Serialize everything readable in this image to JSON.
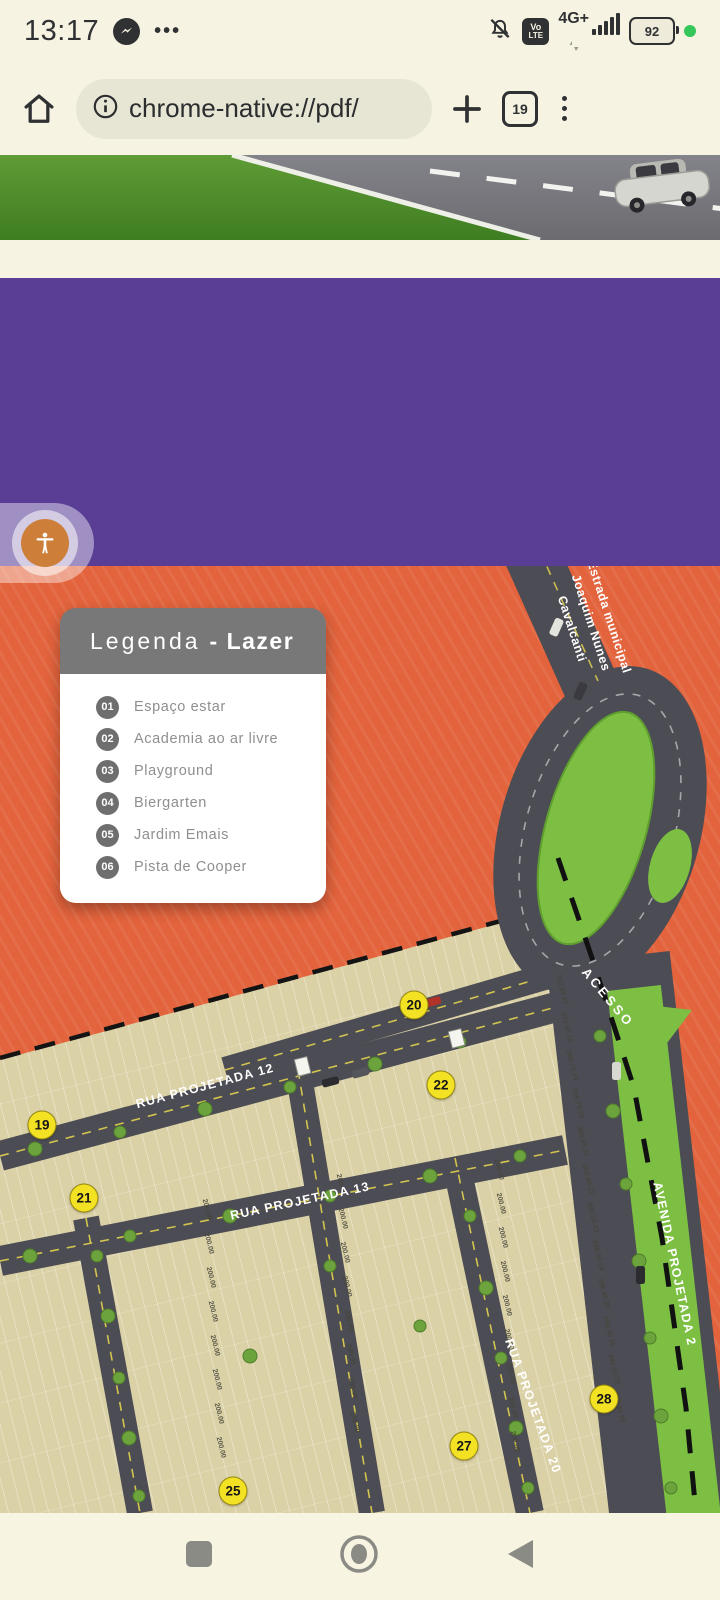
{
  "status_bar": {
    "time": "13:17",
    "more_icon": "•••",
    "carrier_badge_top": "Vo",
    "carrier_badge_bottom": "LTE",
    "network": "4G+",
    "battery": "92"
  },
  "toolbar": {
    "url": "chrome-native://pdf/",
    "tab_count": "19"
  },
  "pdf_banner": {
    "headline": "ESCOLHA AQUI"
  },
  "legend": {
    "title_light": "Legenda",
    "title_bold": "- Lazer",
    "items": [
      {
        "num": "01",
        "label": "Espaço estar"
      },
      {
        "num": "02",
        "label": "Academia ao ar livre"
      },
      {
        "num": "03",
        "label": "Playground"
      },
      {
        "num": "04",
        "label": "Biergarten"
      },
      {
        "num": "05",
        "label": "Jardim Emais"
      },
      {
        "num": "06",
        "label": "Pista de Cooper"
      }
    ]
  },
  "map": {
    "estrada_label": [
      "Estrada municipal",
      "Joaquim Nunes",
      "Cavalcanti"
    ],
    "acesso_label": "ACESSO",
    "street_labels": [
      {
        "id": "rua12",
        "text": "RUA PROJETADA 12"
      },
      {
        "id": "rua13",
        "text": "RUA PROJETADA 13"
      },
      {
        "id": "rua20",
        "text": "RUA PROJETADA 20"
      },
      {
        "id": "avenida",
        "text": "AVENIDA PROJETADA 2"
      }
    ],
    "markers": [
      {
        "label": "19",
        "x": 42,
        "y": 559
      },
      {
        "label": "20",
        "x": 414,
        "y": 439
      },
      {
        "label": "21",
        "x": 84,
        "y": 632
      },
      {
        "label": "22",
        "x": 441,
        "y": 519
      },
      {
        "label": "25",
        "x": 233,
        "y": 925
      },
      {
        "label": "27",
        "x": 464,
        "y": 880
      },
      {
        "label": "28",
        "x": 604,
        "y": 833
      }
    ],
    "lot_measurements": [
      "312.85",
      "310.80",
      "308.75",
      "306.70",
      "304.65",
      "302.60",
      "300.55",
      "298.50",
      "296.45",
      "294.40",
      "292.35",
      "290.30"
    ],
    "lot_numbers_right": [
      "17",
      "18",
      "19",
      "20",
      "21",
      "22",
      "23",
      "24",
      "25",
      "26",
      "27",
      "28"
    ],
    "lot_measure_repeat": "200.00"
  }
}
